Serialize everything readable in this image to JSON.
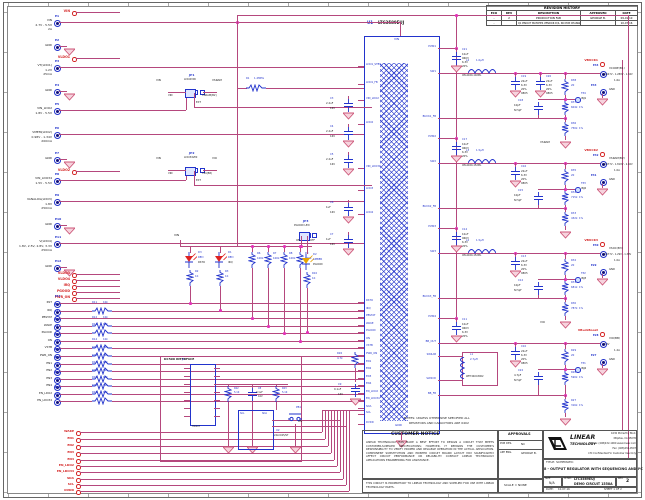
{
  "colors": {
    "wire": "#b5487d",
    "component": "#2233cc",
    "net_label": "#d42424",
    "junction": "#e332b8",
    "gnd_symbol": "#cc5577",
    "led_red": "#dd2222",
    "led_amber": "#e8a300"
  },
  "revision_history": {
    "title": "REVISION HISTORY",
    "headers": [
      "ECO",
      "REV",
      "DESCRIPTION",
      "APPROVED",
      "DATE"
    ],
    "rows": [
      [
        "-",
        "2",
        "PRODUCTION FAB",
        "GEORGE B.",
        "09-01-10"
      ],
      [
        "-",
        "",
        "Q1 PINOUT MATCHES VENDOR D/S, NO PCB CHANGE",
        "",
        "10-07-16"
      ]
    ]
  },
  "notes": {
    "line1": "NOTES: UNLESS OTHERWISE SPECIFIED ALL",
    "line2": "RESISTORS AND CAPACITORS ARE 0402"
  },
  "ic": {
    "ref": "U1",
    "part": "LTC3589EUJ",
    "top_pin": "VIN",
    "bottom_pin": "GND",
    "left_pins": [
      "LDO1_STBY",
      "LDO1_FB",
      "VIN_LDO2",
      "LDO2",
      "VIN_LDO34",
      "LDO3",
      "LDO4",
      "RSTO",
      "IRQ",
      "PBSTAT",
      "WAKE",
      "PGOOD",
      "ON",
      "VSTB",
      "PWR_ON",
      "EN1",
      "EN2",
      "EN3",
      "EN4",
      "EN_LDO2",
      "EN_LDO34",
      "SDA",
      "SCL",
      "DVDD"
    ],
    "right_pins": [
      "PVIN1",
      "SW1",
      "BUCK1_FB",
      "PVIN2",
      "SW2",
      "BUCK2_FB",
      "PVIN3",
      "SW3",
      "BUCK3_FB",
      "PVIN4",
      "BB_OUT",
      "SW4AB",
      "SW4CD",
      "BB_FB"
    ]
  },
  "left_items": [
    {
      "kind": "net",
      "label": "VIN"
    },
    {
      "kind": "term",
      "id": "E1",
      "lines": [
        "VIN",
        "2.7V - 5.5V",
        "2A"
      ]
    },
    {
      "kind": "gnd",
      "id": "E2",
      "label": "GND"
    },
    {
      "kind": "net",
      "label": "VLDO1"
    },
    {
      "kind": "term",
      "id": "E3",
      "lines": [
        "VT(LDO1)",
        "1.2V",
        "25mA"
      ]
    },
    {
      "kind": "gnd",
      "id": "E4",
      "label": "GND"
    },
    {
      "kind": "term",
      "id": "E5",
      "lines": [
        "VIN_LDO2",
        "1.8V - 5.5V"
      ]
    },
    {
      "kind": "term",
      "id": "E6",
      "lines": [
        "VMEM(LDO2)",
        "0.98V - 1.34V",
        "200mA"
      ]
    },
    {
      "kind": "gnd",
      "id": "E7",
      "label": "GND"
    },
    {
      "kind": "net",
      "label": "VLDO2"
    },
    {
      "kind": "term",
      "id": "E8",
      "lines": [
        "VIN_LDO34",
        "1.5V - 5.5V"
      ]
    },
    {
      "kind": "term",
      "id": "E9",
      "lines": [
        "VANALOG(LDO3)",
        "1.8V",
        "250mA"
      ]
    },
    {
      "kind": "gnd",
      "id": "E10",
      "label": "GND"
    },
    {
      "kind": "term",
      "id": "E11",
      "lines": [
        "V(LDO4)",
        "1.8V, 2.5V, 2.8V, 3.3V",
        "250mA"
      ]
    },
    {
      "kind": "gnd",
      "id": "E12",
      "label": "GND"
    },
    {
      "kind": "net",
      "label": "VLDO3"
    },
    {
      "kind": "net",
      "label": "VLDO4"
    },
    {
      "kind": "net",
      "label": "IRQ"
    },
    {
      "kind": "net",
      "label": "PGOOD"
    },
    {
      "kind": "net",
      "label": "PWR_ON"
    }
  ],
  "signal_terminals": [
    {
      "id": "E13",
      "name": "RST"
    },
    {
      "id": "E14",
      "name": "IRQ",
      "res": {
        "ref": "R11",
        "val": "10k"
      }
    },
    {
      "id": "E15",
      "name": "PBSTAT"
    },
    {
      "id": "E16",
      "name": "WAKE",
      "res": {
        "ref": "R12",
        "val": "10k"
      }
    },
    {
      "id": "E17",
      "name": "PGOOD",
      "res": {
        "ref": "R13",
        "val": "10k"
      }
    },
    {
      "id": "E18",
      "name": "ON"
    },
    {
      "id": "E19",
      "name": "VSTB",
      "res": {
        "ref": "R14",
        "val": "10k"
      }
    },
    {
      "id": "E20",
      "name": "PWR_ON",
      "res": {
        "ref": "R15",
        "val": "10k"
      }
    },
    {
      "id": "E21",
      "name": "EN1",
      "res": {
        "ref": "R16",
        "val": "10k"
      }
    },
    {
      "id": "E22",
      "name": "EN2",
      "res": {
        "ref": "R17",
        "val": "10k"
      }
    },
    {
      "id": "E23",
      "name": "EN3",
      "res": {
        "ref": "R18",
        "val": "10k"
      }
    },
    {
      "id": "E24",
      "name": "EN4",
      "res": {
        "ref": "R19",
        "val": "10k"
      }
    },
    {
      "id": "E25",
      "name": "EN_LDO2",
      "res": {
        "ref": "R20",
        "val": "10k"
      }
    },
    {
      "id": "E26",
      "name": "EN_LDO34",
      "res": {
        "ref": "R21",
        "val": "10k"
      }
    }
  ],
  "bottom_nets": [
    "WAKE",
    "EN1",
    "EN2",
    "EN3",
    "EN4",
    "EN_LDO2",
    "EN_LDO34",
    "SDA",
    "SCL",
    "DVDD"
  ],
  "jumpers": {
    "jp1": {
      "ref": "JP1",
      "name": "LDO2VIN",
      "left": "VIN",
      "right": "VSRAM",
      "sub_left": "VIN",
      "sub_right": "VSRAM(B2)",
      "bottom": "EXT"
    },
    "jp2": {
      "ref": "JP2",
      "name": "LDO34VIN",
      "left": "VIN",
      "right": "VIO",
      "sub_left": "VIN",
      "sub_right": "VIO(B8)",
      "bottom": "EXT"
    },
    "jp3": {
      "ref": "JP3",
      "name": "PGOOD LED",
      "left": "ON",
      "right": "OFF"
    }
  },
  "leds": [
    {
      "ref": "D3",
      "color_name": "RED",
      "net": "RSTO",
      "res_ref": "R2",
      "res_val": "1K"
    },
    {
      "ref": "D1",
      "color_name": "RED",
      "net": "IRQ",
      "res_ref": "R3",
      "res_val": "1K"
    },
    {
      "ref": "D2",
      "color_name": "AMBER",
      "net": "PGOOD",
      "res_ref": "R10",
      "res_val": "1K"
    }
  ],
  "pullups": [
    {
      "ref": "R6",
      "val": "100k"
    },
    {
      "ref": "R7",
      "val": "100k"
    },
    {
      "ref": "R8",
      "val": "100k"
    },
    {
      "ref": "R9",
      "val": "100k"
    }
  ],
  "misc": {
    "vin_label": "VIN",
    "r1_ref": "R1",
    "r1_val": "1.2MEG",
    "r26_ref": "R26",
    "r26_val": "4.7k",
    "c9_ref": "C9",
    "c9_val": "0.1uF",
    "c9_v": "16V",
    "ldo_caps": [
      {
        "ref": "C3",
        "val": "2.2uF",
        "v": "16V"
      },
      {
        "ref": "C4",
        "val": "2.2uF",
        "v": "16V"
      },
      {
        "ref": "C5",
        "val": "2.2uF",
        "v": "16V"
      },
      {
        "ref": "C6",
        "val": "1uF",
        "v": "16V"
      },
      {
        "ref": "C7",
        "val": "1uF",
        "v": "16V"
      }
    ]
  },
  "dc590": {
    "title": "DC590 INTERFACE",
    "j1_ref": "J1",
    "j1_part": "HD2X7",
    "r22_ref": "R22",
    "r22_val": "5.1K",
    "c8_ref": "C8",
    "c8_val": "0.1uF",
    "c8_v": "16V",
    "r23_ref": "R23",
    "r23_val": "5.1K",
    "u2_ref": "U2",
    "u2_part": "24LC025/ST",
    "u2_pin_left": "SCL",
    "u2_pin_right": "SDA",
    "pb1_ref": "PB1",
    "pb1_label": "ON"
  },
  "outputs": [
    {
      "net": "VBUCK1",
      "cin": {
        "ref": "C21",
        "l1": "10uF",
        "l2": "0603",
        "l3": "6.3V",
        "l4": "20%"
      },
      "ind": {
        "ref": "L4",
        "val": "1.0µH",
        "part": "XPL4020-102ML"
      },
      "cout": {
        "ref": "C19",
        "l1": "22uF",
        "l2": "6.3V",
        "l3": "20%",
        "l4": "0805"
      },
      "cout2": {
        "ref": "C20",
        "l1": "22uF",
        "l2": "6.3V",
        "l3": "20%",
        "l4": "0805"
      },
      "rinj": {
        "ref": "R38",
        "val": "20"
      },
      "tp": {
        "ref": "TP4",
        "label": "INJ1"
      },
      "cfb": {
        "ref": "C18",
        "val": "10pF",
        "note": "NI 5pF"
      },
      "rtop": {
        "ref": "R37",
        "val": "604k",
        "tol": "1%"
      },
      "rbot": {
        "ref": "R36",
        "val": "750k",
        "tol": "1%"
      },
      "pre": "",
      "term": {
        "id": "E34",
        "name": "VCORE(B1)",
        "range": "0.647V - 1.289V - 1.34V",
        "amps": "1.6A"
      },
      "gnd": {
        "id": "E33",
        "label": "GND"
      }
    },
    {
      "net": "VBUCK2",
      "cin": {
        "ref": "C17",
        "l1": "10uF",
        "l2": "0603",
        "l3": "6.3V",
        "l4": "20%"
      },
      "ind": {
        "ref": "L3",
        "val": "1.5µH",
        "part": "XPL4020-152ML"
      },
      "cout": {
        "ref": "C16",
        "l1": "22uF",
        "l2": "6.3V",
        "l3": "20%",
        "l4": "0805"
      },
      "rinj": {
        "ref": "R35",
        "val": "20"
      },
      "tp": {
        "ref": "TP3",
        "label": "INJ2"
      },
      "cfb": {
        "ref": "C15",
        "val": "10pF",
        "note": "NI 5pF"
      },
      "rtop": {
        "ref": "R34",
        "val": "715k",
        "tol": "1%"
      },
      "rbot": {
        "ref": "R33",
        "val": "432k",
        "tol": "1%"
      },
      "pre": "VSRAM",
      "term": {
        "id": "E32",
        "name": "VSRAM(B2)",
        "range": "0.677V - 1.819V - 2.02V",
        "amps": "1.0A"
      },
      "gnd": {
        "id": "E31",
        "label": "GND"
      }
    },
    {
      "net": "VBUCK3",
      "cin": {
        "ref": "C14",
        "l1": "10uF",
        "l2": "0603",
        "l3": "6.3V",
        "l4": "20%"
      },
      "ind": {
        "ref": "L2",
        "val": "1.5µH",
        "part": "XPL4020-152ML"
      },
      "cout": {
        "ref": "C13",
        "l1": "22uF",
        "l2": "6.3V",
        "l3": "20%",
        "l4": "0805"
      },
      "rinj": {
        "ref": "R32",
        "val": "20"
      },
      "tp": {
        "ref": "TP2",
        "label": "INJ3"
      },
      "cfb": {
        "ref": "C12",
        "val": "10pF",
        "note": "NI 5pF"
      },
      "rtop": {
        "ref": "R31",
        "val": "681k",
        "tol": "1%"
      },
      "rbot": {
        "ref": "R30",
        "val": "787k",
        "tol": "1%"
      },
      "pre": "",
      "term": {
        "id": "E30",
        "name": "VSOC(B3)",
        "range": "0.677V - 1.29V - 1.39V",
        "amps": "1.0A"
      },
      "gnd": {
        "id": "E29",
        "label": "GND"
      }
    },
    {
      "net": "VBuckBoost",
      "loop": true,
      "cin": {
        "ref": "C11",
        "l1": "10uF",
        "l2": "0603",
        "l3": "6.3V",
        "l4": "20%"
      },
      "ind": {
        "ref": "L1",
        "val": "2.7µH",
        "part": "WE744043002"
      },
      "cout": {
        "ref": "C10",
        "l1": "22uF",
        "l2": "6.3V",
        "l3": "20%",
        "l4": "0805"
      },
      "rinj": {
        "ref": "R29",
        "val": "20"
      },
      "tp": {
        "ref": "TP1",
        "label": "INJ4"
      },
      "cfb": {
        "ref": "C22",
        "val": "4.7pF",
        "note": "NI 5pF"
      },
      "rtop": {
        "ref": "R28",
        "val": "590k",
        "tol": "1%"
      },
      "rbot": {
        "ref": "R27",
        "val": "316k",
        "tol": "1%"
      },
      "pre": "VIO",
      "term": {
        "id": "E28",
        "name": "VIO(BB)",
        "range": "3.3V",
        "amps": "1.2A"
      },
      "gnd": {
        "id": "E27",
        "label": "GND"
      }
    }
  ],
  "title_block": {
    "customer_notice_title": "CUSTOMER NOTICE",
    "customer_notice_body": "LINEAR TECHNOLOGY HAS MADE A BEST EFFORT TO DESIGN A CIRCUIT THAT MEETS CUSTOMER-SUPPLIED SPECIFICATIONS; HOWEVER, IT REMAINS THE CUSTOMER'S RESPONSIBILITY TO VERIFY PROPER AND RELIABLE OPERATION IN THE ACTUAL APPLICATION. COMPONENT SUBSTITUTION AND PRINTED CIRCUIT BOARD LAYOUT MAY SIGNIFICANTLY AFFECT CIRCUIT PERFORMANCE OR RELIABILITY. CONTACT LINEAR TECHNOLOGY APPLICATIONS ENGINEERING FOR ASSISTANCE.",
    "proprietary_note": "THIS CIRCUIT IS PROPRIETARY TO LINEAR TECHNOLOGY AND SUPPLIED FOR USE WITH LINEAR TECHNOLOGY PARTS.",
    "approvals_label": "APPROVALS",
    "approvals": [
      {
        "role": "PCB DES.",
        "name": "NC"
      },
      {
        "role": "APP ENG.",
        "name": "GEORGE B."
      }
    ],
    "scale": "SCALE = NONE",
    "company_line1": "LINEAR",
    "company_line2": "TECHNOLOGY",
    "address": [
      "1630 McCarthy Blvd.",
      "Milpitas, CA 95035",
      "Phone: (408)432-1900  www.linear.com",
      "Fax: (408)434-0507",
      "LTC Confidential-For Customer Use Only"
    ],
    "title_label": "TITLE: SCHEMATIC",
    "title": "8 - OUTPUT REGULATOR WITH SEQUENCING AND I²C",
    "size_label": "SIZE",
    "size": "N/A",
    "ic_no_label": "IC NO.",
    "ic_no": "LTC3589EUJ",
    "board": "DEMO CIRCUIT 1558A",
    "rev_label": "REV.",
    "rev": "2",
    "date_label": "DATE:",
    "date": "10-07-16",
    "sheet_info": "SHEET  1  OF  2"
  }
}
